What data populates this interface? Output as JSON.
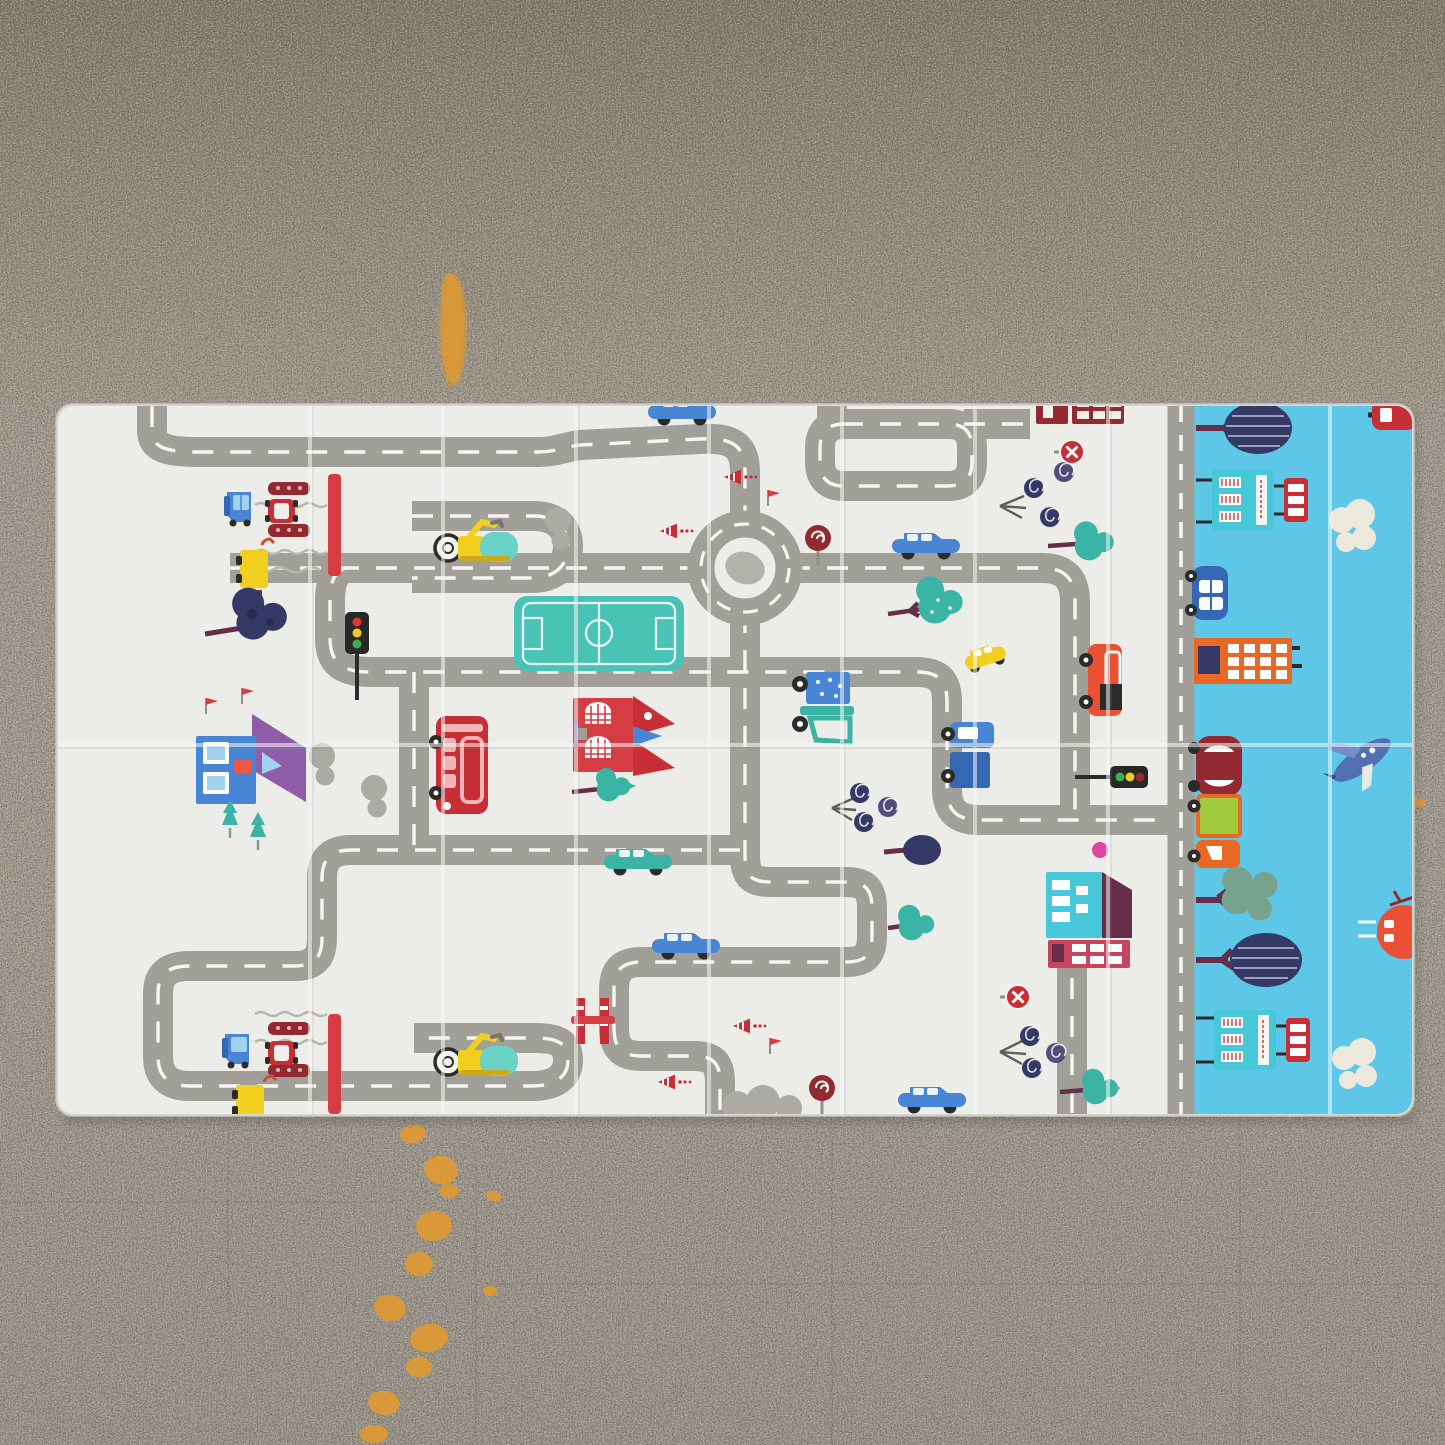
{
  "scene": {
    "type": "photograph",
    "subject": "Foldable baby play mat with a road-map print, photographed top-down on a speckled concrete floor",
    "floor": {
      "material": "gray speckled concrete",
      "marks": [
        "orange paint streak above the mat near its top-left corner",
        "orange paint drip trail running from below the mat to the bottom edge",
        "small orange dash on the floor right of the mat"
      ]
    },
    "mat": {
      "panels": [
        "white road-map play panel",
        "light-blue cityscape side panel"
      ],
      "creases": {
        "vertical_folds": 7,
        "horizontal_folds": 1
      }
    }
  },
  "palette": {
    "floor_top": "#81776b",
    "floor_upper": "#94897c",
    "floor_mid": "#a39d93",
    "floor_low": "#99938a",
    "speck_dark": "#4e463d",
    "speck_light": "#d6d0c4",
    "seam": "#5f574c",
    "paint": "#e09a33",
    "mat_white": "#ebece8",
    "mat_edge": "#d9d9d3",
    "crease": "#f8f8f6",
    "mat_blue": "#56c5e6",
    "road": "#9b9b93",
    "road_dash": "#fafaf7",
    "roundabout_center": "#aeaea6",
    "cloud_gray": "#a7a79f",
    "cloud_white": "#ece7db",
    "red": "#c4232c",
    "crimson": "#d4323a",
    "dark_red": "#8e1f26",
    "maroon": "#5f2340",
    "pink": "#e0399b",
    "pink_win": "#f2b0b4",
    "yellow": "#f2cd12",
    "orange": "#e86018",
    "lime": "#9cc832",
    "teal": "#30b0a0",
    "field_teal": "#3fc0b1",
    "teal_bld": "#3ec6d6",
    "blue": "#3f7fd2",
    "blue_dark": "#2a5fb0",
    "window_blue": "#9cd0f0",
    "navy": "#2b2f5e",
    "purple": "#8a55a4",
    "sage": "#6f9e88",
    "black": "#20201e",
    "white": "#ffffff"
  },
  "objects": [
    {
      "name": "road-network",
      "panel": "white",
      "color": "road"
    },
    {
      "name": "boundary-road",
      "panel": "white",
      "color": "road",
      "x": 1181,
      "y": 760
    },
    {
      "name": "roundabout",
      "panel": "white",
      "color": "road",
      "x": 745,
      "y": 568
    },
    {
      "name": "football-field",
      "panel": "white",
      "color": "field_teal",
      "x": 598,
      "y": 633
    },
    {
      "name": "railway-crossing-top",
      "panel": "white",
      "color": "dark_red",
      "x": 283,
      "y": 535
    },
    {
      "name": "railway-crossing-bottom",
      "panel": "white",
      "color": "dark_red",
      "x": 283,
      "y": 1065
    },
    {
      "name": "crossing-barrier-center",
      "panel": "white",
      "color": "red",
      "x": 595,
      "y": 1020
    },
    {
      "name": "red-double-decker-bus",
      "panel": "white",
      "color": "red",
      "x": 460,
      "y": 765
    },
    {
      "name": "red-house",
      "panel": "white",
      "color": "crimson",
      "x": 615,
      "y": 735
    },
    {
      "name": "blue-house",
      "panel": "white",
      "color": "blue",
      "x": 235,
      "y": 760
    },
    {
      "name": "teal-house",
      "panel": "white",
      "color": "teal_bld",
      "x": 1085,
      "y": 905
    },
    {
      "name": "pink-building",
      "panel": "white",
      "color": "crimson",
      "x": 1090,
      "y": 954
    },
    {
      "name": "dark-red-building",
      "panel": "white",
      "color": "dark_red",
      "x": 1080,
      "y": 410
    },
    {
      "name": "excavator-top",
      "panel": "white",
      "color": "yellow",
      "x": 480,
      "y": 548
    },
    {
      "name": "excavator-bottom",
      "panel": "white",
      "color": "yellow",
      "x": 480,
      "y": 1062
    },
    {
      "name": "garbage-truck",
      "panel": "white",
      "color": "teal",
      "x": 822,
      "y": 700
    },
    {
      "name": "blue-van-top",
      "panel": "white",
      "color": "blue",
      "x": 240,
      "y": 505
    },
    {
      "name": "blue-van-bottom",
      "panel": "white",
      "color": "blue",
      "x": 238,
      "y": 1047
    },
    {
      "name": "red-mini-car-top",
      "panel": "white",
      "color": "red",
      "x": 281,
      "y": 511
    },
    {
      "name": "red-mini-car-bottom",
      "panel": "white",
      "color": "red",
      "x": 281,
      "y": 1053
    },
    {
      "name": "yellow-truck-top",
      "panel": "white",
      "color": "yellow",
      "x": 253,
      "y": 570
    },
    {
      "name": "yellow-truck-bottom",
      "panel": "white",
      "color": "yellow",
      "x": 249,
      "y": 1103
    },
    {
      "name": "blue-wagon-car-1",
      "panel": "white",
      "color": "blue",
      "x": 683,
      "y": 412
    },
    {
      "name": "blue-wagon-car-2",
      "panel": "white",
      "color": "blue",
      "x": 925,
      "y": 545
    },
    {
      "name": "blue-wagon-car-3",
      "panel": "white",
      "color": "blue",
      "x": 687,
      "y": 945
    },
    {
      "name": "blue-wagon-car-4",
      "panel": "white",
      "color": "blue",
      "x": 932,
      "y": 1098
    },
    {
      "name": "teal-car",
      "panel": "white",
      "color": "teal",
      "x": 638,
      "y": 860
    },
    {
      "name": "yellow-car",
      "panel": "white",
      "color": "yellow",
      "x": 982,
      "y": 657
    },
    {
      "name": "blue-truck",
      "panel": "white",
      "color": "blue",
      "x": 970,
      "y": 755
    },
    {
      "name": "orange-truck",
      "panel": "white",
      "color": "orange",
      "x": 1100,
      "y": 680
    },
    {
      "name": "traffic-light-vertical",
      "panel": "white",
      "color": "black",
      "x": 357,
      "y": 634
    },
    {
      "name": "traffic-light-horizontal",
      "panel": "white",
      "color": "black",
      "x": 1125,
      "y": 776
    },
    {
      "name": "no-entry-sign-top",
      "panel": "white",
      "color": "red",
      "x": 1072,
      "y": 452
    },
    {
      "name": "no-entry-sign-bottom",
      "panel": "white",
      "color": "red",
      "x": 1018,
      "y": 997
    },
    {
      "name": "lollipop-sign-top",
      "panel": "white",
      "color": "dark_red",
      "x": 818,
      "y": 538
    },
    {
      "name": "lollipop-sign-bottom",
      "panel": "white",
      "color": "dark_red",
      "x": 822,
      "y": 1090
    },
    {
      "name": "traffic-cones",
      "panel": "white",
      "color": "red",
      "x": 700,
      "y": 520
    },
    {
      "name": "red-flags",
      "panel": "white",
      "color": "red",
      "x": 770,
      "y": 497
    },
    {
      "name": "dark-tree",
      "panel": "white",
      "color": "navy",
      "x": 262,
      "y": 618
    },
    {
      "name": "navy-ball-tree",
      "panel": "white",
      "color": "navy",
      "x": 920,
      "y": 850
    },
    {
      "name": "spiral-trees-top",
      "panel": "white",
      "color": "navy",
      "x": 1045,
      "y": 492
    },
    {
      "name": "spiral-trees-center",
      "panel": "white",
      "color": "navy",
      "x": 868,
      "y": 805
    },
    {
      "name": "spiral-trees-bottom",
      "panel": "white",
      "color": "navy",
      "x": 1038,
      "y": 1050
    },
    {
      "name": "teal-tree-1",
      "panel": "white",
      "color": "teal",
      "x": 950,
      "y": 605
    },
    {
      "name": "teal-tree-2",
      "panel": "white",
      "color": "teal",
      "x": 1100,
      "y": 542
    },
    {
      "name": "teal-tree-3",
      "panel": "white",
      "color": "teal",
      "x": 618,
      "y": 788
    },
    {
      "name": "teal-tree-4",
      "panel": "white",
      "color": "teal",
      "x": 918,
      "y": 925
    },
    {
      "name": "teal-tree-5",
      "panel": "white",
      "color": "teal",
      "x": 1105,
      "y": 1088
    },
    {
      "name": "pine-trees",
      "panel": "white",
      "color": "teal",
      "x": 240,
      "y": 820
    },
    {
      "name": "gray-clouds",
      "panel": "white",
      "color": "cloud_gray",
      "x": 345,
      "y": 780
    },
    {
      "name": "striped-ball-tree-1",
      "panel": "blue",
      "color": "navy",
      "x": 1252,
      "y": 428
    },
    {
      "name": "striped-ball-tree-2",
      "panel": "blue",
      "color": "navy",
      "x": 1262,
      "y": 960
    },
    {
      "name": "sage-tree",
      "panel": "blue",
      "color": "sage",
      "x": 1250,
      "y": 898
    },
    {
      "name": "teal-building-1",
      "panel": "blue",
      "color": "teal_bld",
      "x": 1242,
      "y": 500
    },
    {
      "name": "teal-building-2",
      "panel": "blue",
      "color": "teal_bld",
      "x": 1247,
      "y": 1040
    },
    {
      "name": "red-minibus-1",
      "panel": "blue",
      "color": "red",
      "x": 1287,
      "y": 505
    },
    {
      "name": "red-minibus-2",
      "panel": "blue",
      "color": "red",
      "x": 1289,
      "y": 1044
    },
    {
      "name": "white-cloud-1",
      "panel": "blue",
      "color": "cloud_white",
      "x": 1352,
      "y": 530
    },
    {
      "name": "white-cloud-2",
      "panel": "blue",
      "color": "cloud_white",
      "x": 1352,
      "y": 1066
    },
    {
      "name": "blue-city-car",
      "panel": "blue",
      "color": "blue_dark",
      "x": 1205,
      "y": 592
    },
    {
      "name": "orange-building",
      "panel": "blue",
      "color": "orange",
      "x": 1242,
      "y": 660
    },
    {
      "name": "dark-red-car",
      "panel": "blue",
      "color": "dark_red",
      "x": 1217,
      "y": 766
    },
    {
      "name": "orange-dump-truck",
      "panel": "blue",
      "color": "orange",
      "x": 1216,
      "y": 828
    },
    {
      "name": "jet-plane",
      "panel": "blue",
      "color": "blue_dark",
      "x": 1360,
      "y": 758
    },
    {
      "name": "helicopter",
      "panel": "blue",
      "color": "orange",
      "x": 1398,
      "y": 932
    },
    {
      "name": "corner-red-vehicle",
      "panel": "blue",
      "color": "red",
      "x": 1390,
      "y": 414
    },
    {
      "name": "lamp-posts",
      "panel": "blue",
      "color": "black",
      "x": 1205,
      "y": 520
    },
    {
      "name": "paint-streak-top",
      "panel": "floor",
      "color": "paint",
      "x": 453,
      "y": 335
    },
    {
      "name": "paint-trail-bottom",
      "panel": "floor",
      "color": "paint",
      "x": 420,
      "y": 1280
    },
    {
      "name": "paint-dash-right",
      "panel": "floor",
      "color": "paint",
      "x": 1415,
      "y": 803
    }
  ]
}
